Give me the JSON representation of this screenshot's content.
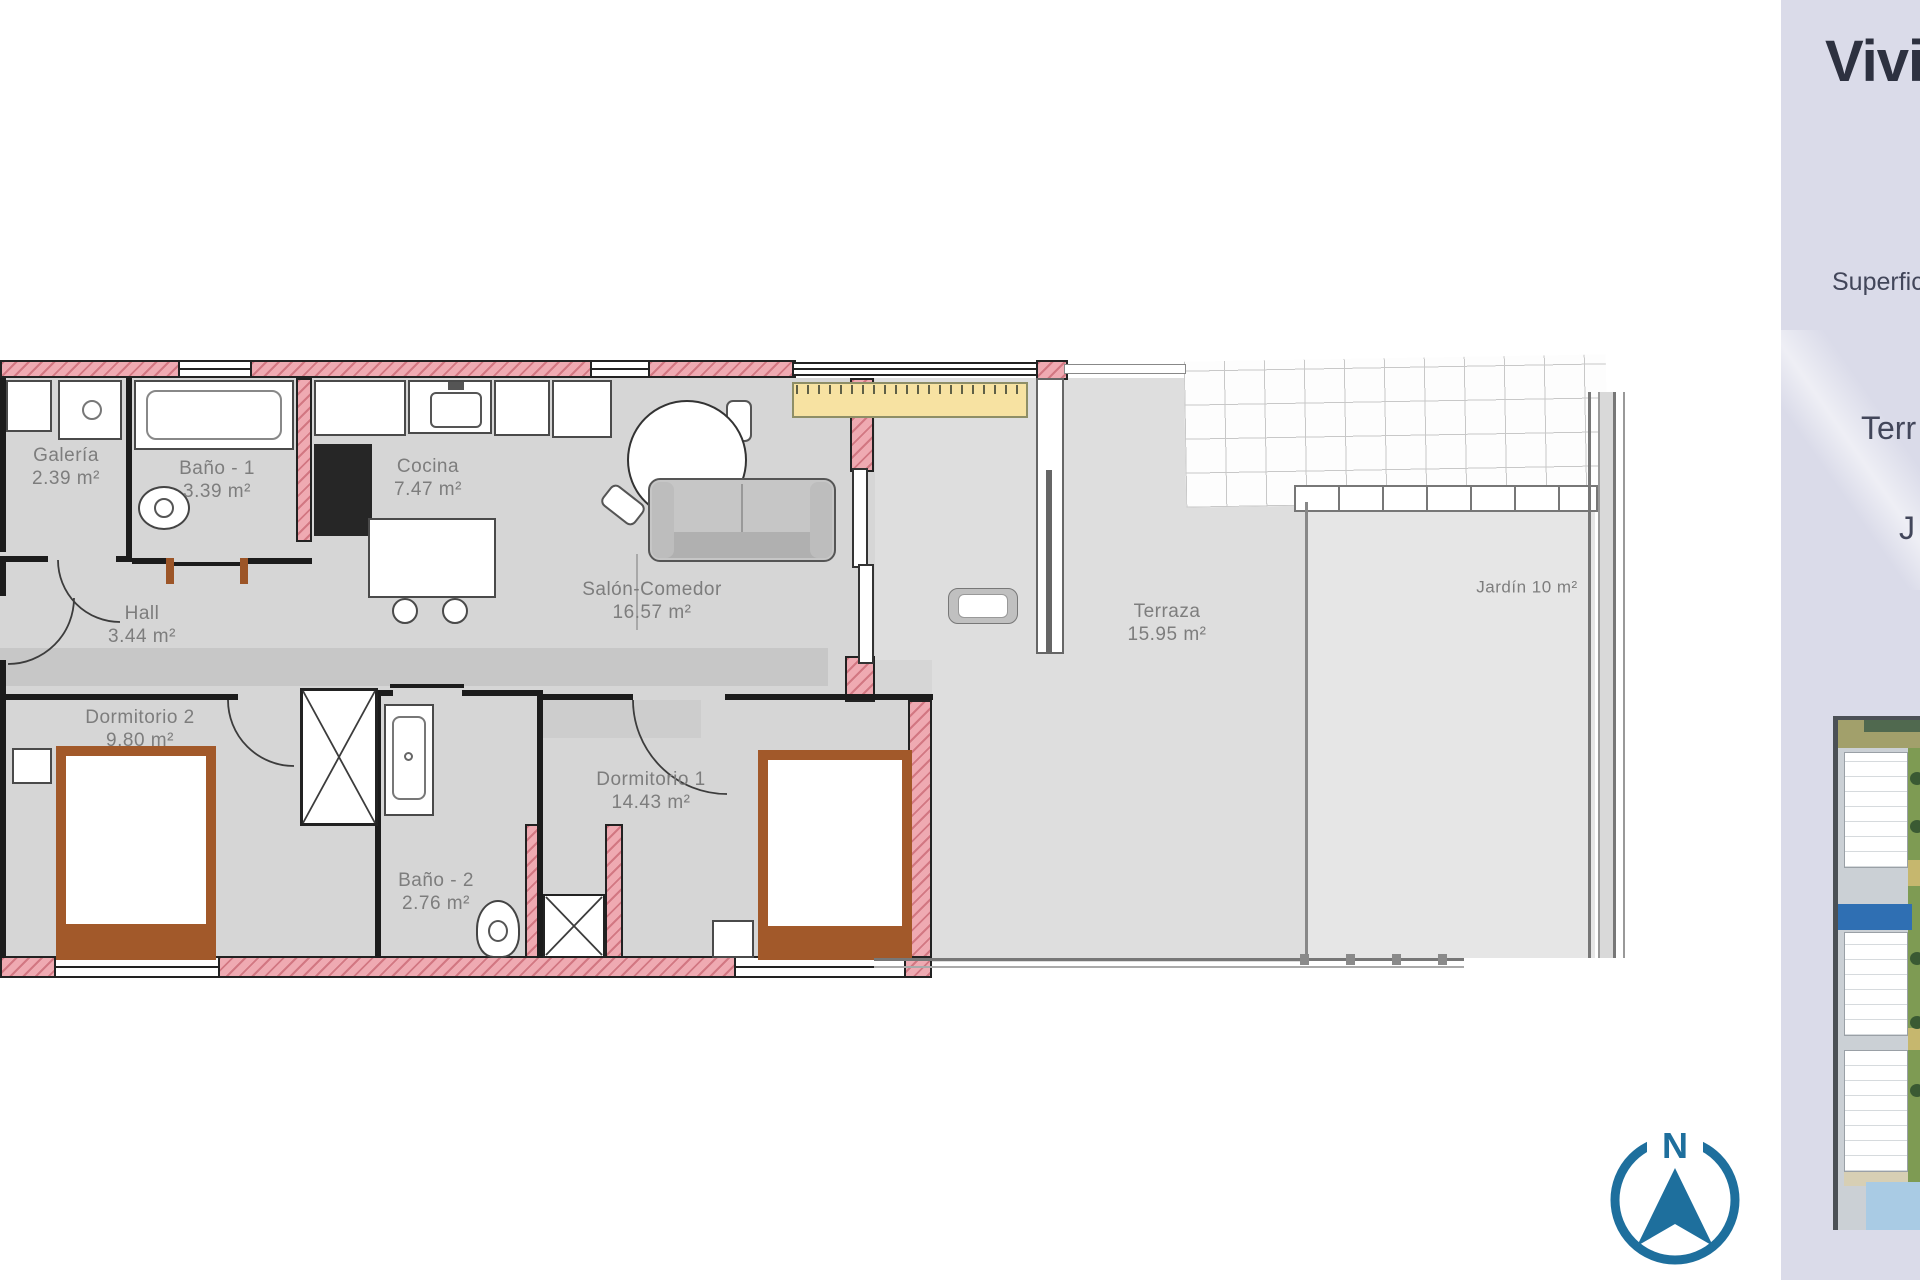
{
  "panel": {
    "title": "Vivie",
    "superficie_label": "Superfic",
    "terraza_label": "Terr",
    "jardin_label": "J",
    "bg_color": "#dadbe9",
    "title_color": "#2d3140",
    "text_color": "#42465a"
  },
  "compass": {
    "north_label": "N",
    "color": "#1e6f9d"
  },
  "floor_plan": {
    "wall_color": "#efaab2",
    "floor_color": "#d6d6d6",
    "rooms": [
      {
        "name": "Galería",
        "area": "2.39 m²"
      },
      {
        "name": "Baño - 1",
        "area": "3.39 m²"
      },
      {
        "name": "Cocina",
        "area": "7.47 m²"
      },
      {
        "name": "Hall",
        "area": "3.44 m²"
      },
      {
        "name": "Salón-Comedor",
        "area": "16.57 m²"
      },
      {
        "name": "Dormitorio 2",
        "area": "9.80 m²"
      },
      {
        "name": "Dormitorio 1",
        "area": "14.43 m²"
      },
      {
        "name": "Baño - 2",
        "area": "2.76 m²"
      },
      {
        "name": "Terraza",
        "area": "15.95 m²"
      },
      {
        "name": "Jardín 10 m²",
        "area": ""
      }
    ]
  }
}
